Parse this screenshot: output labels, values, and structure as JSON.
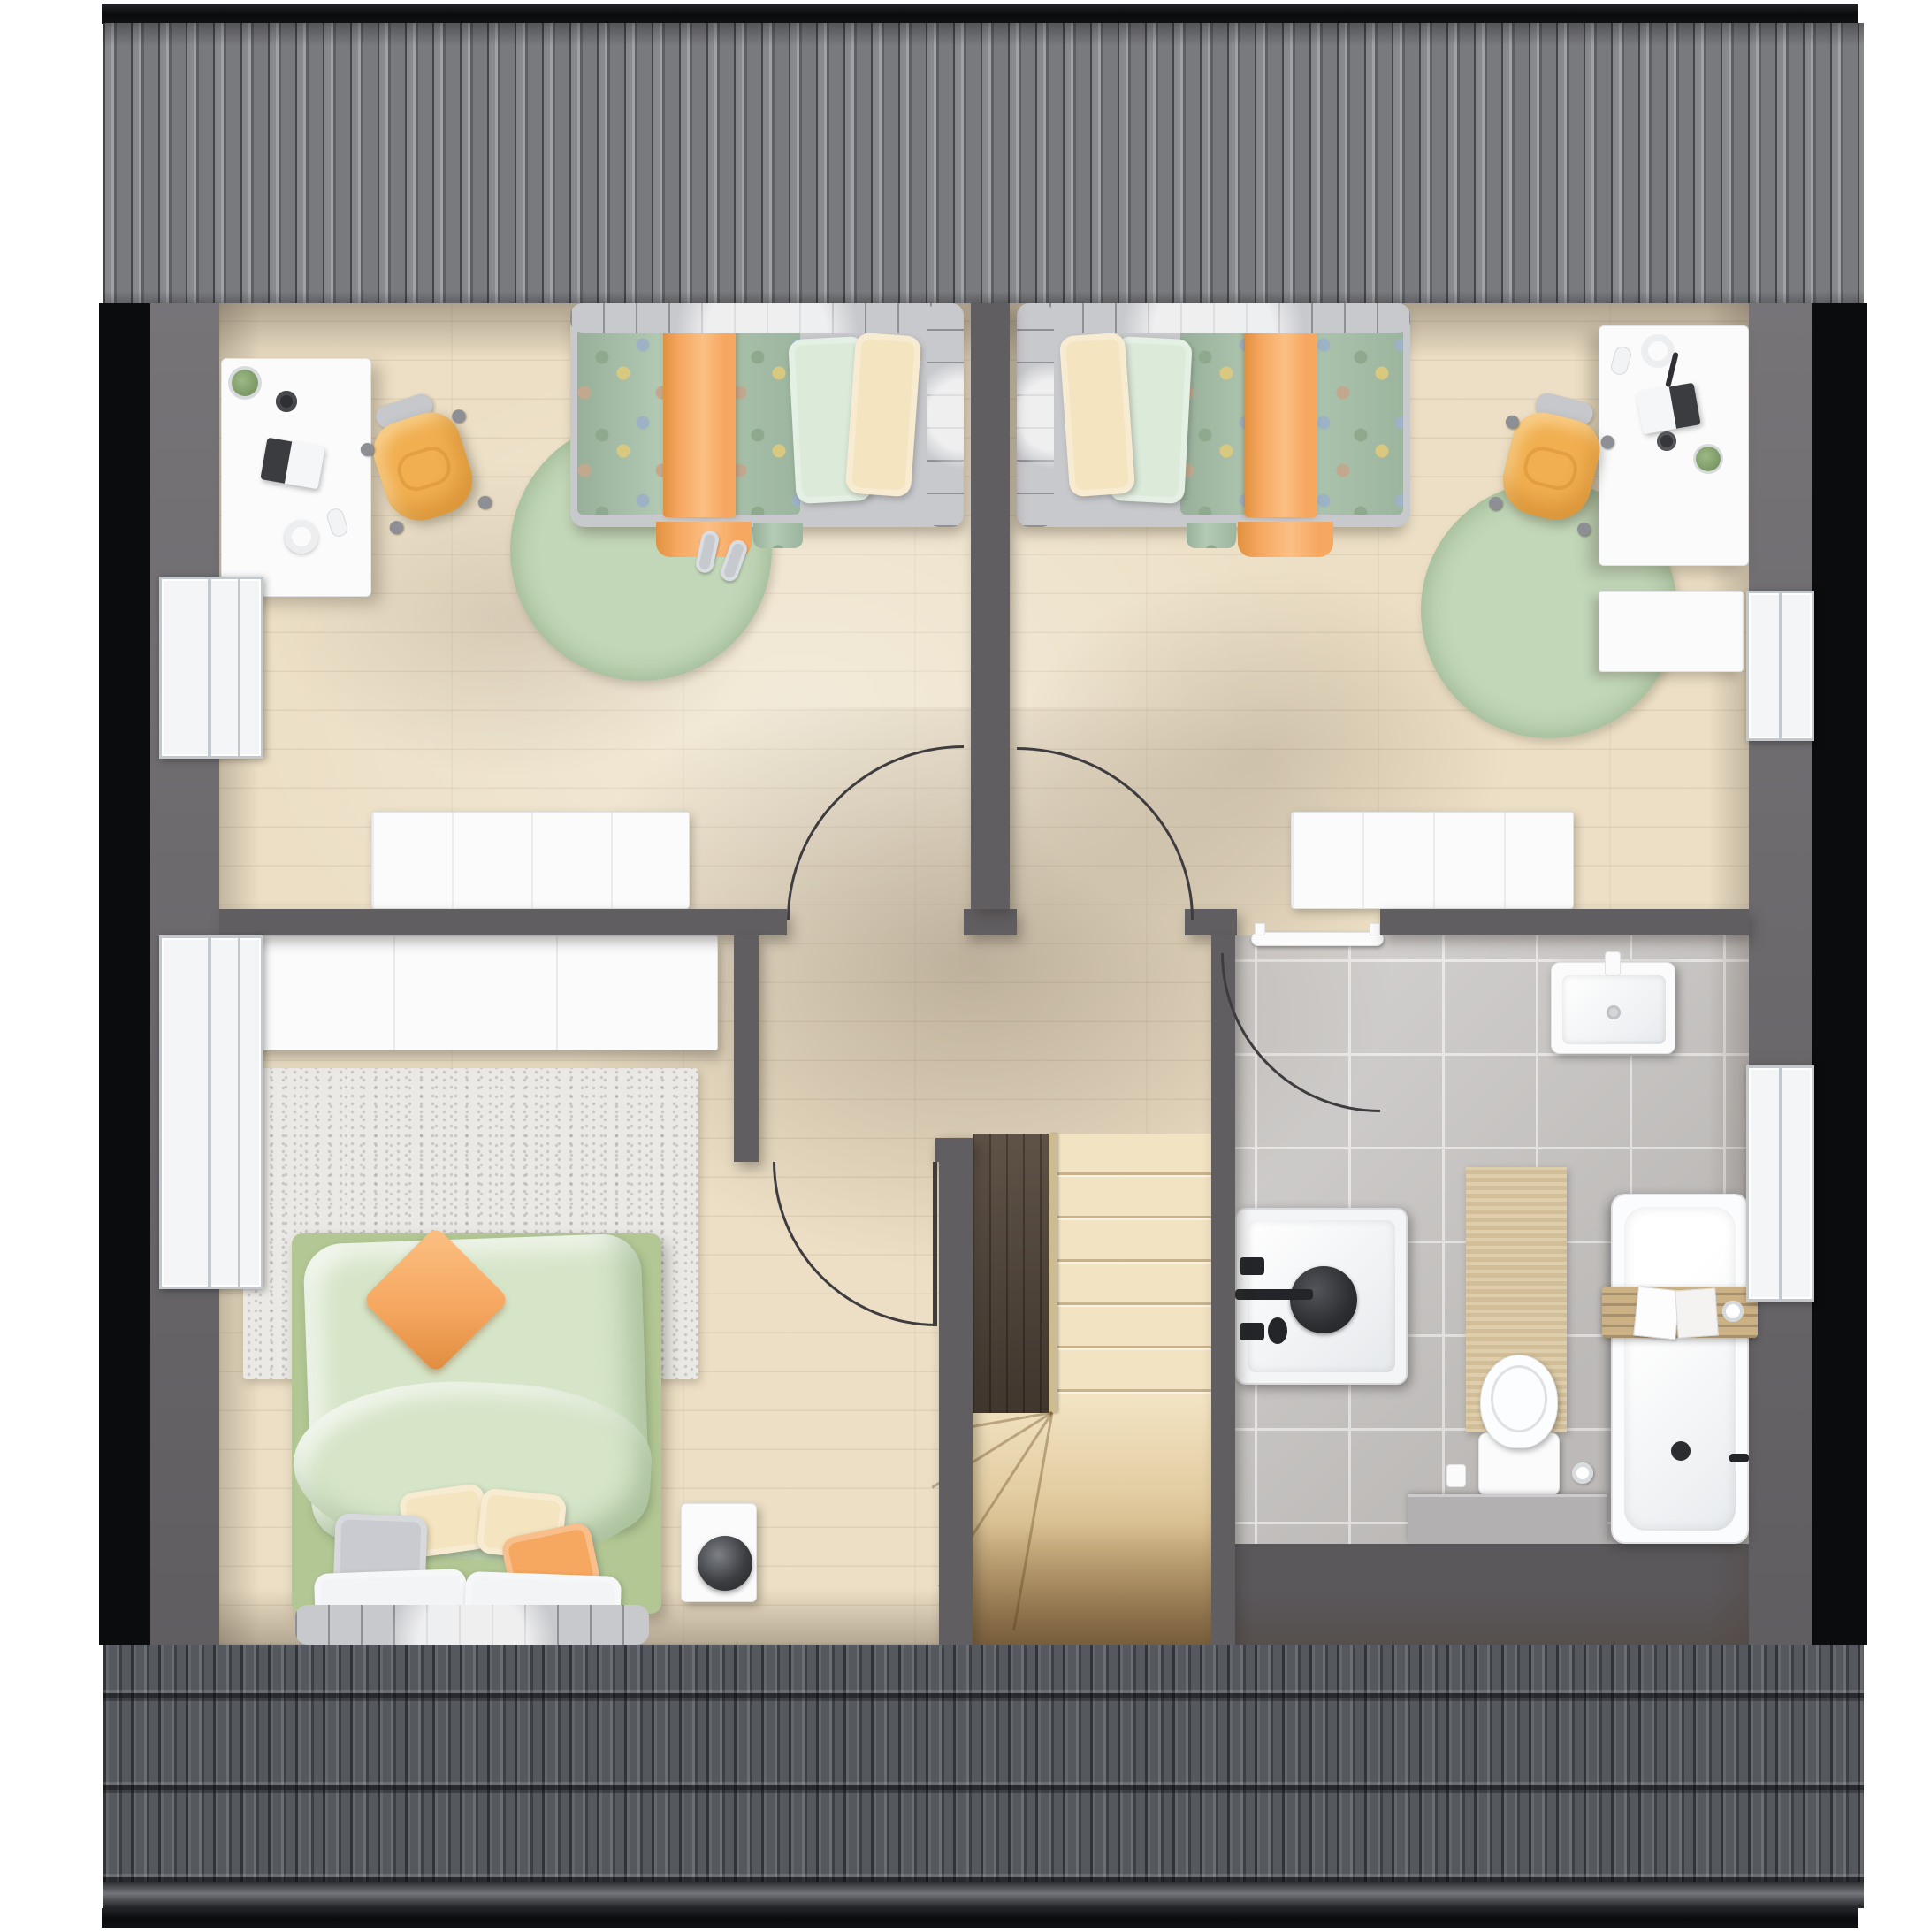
{
  "scene": {
    "title": "Attic storey floor plan – photorealistic top-down render",
    "type": "architectural floor plan",
    "view": "top-down",
    "storey": "attic / upper floor",
    "roof": "ridge with corrugated sheet at top, pan-tile slope at bottom"
  },
  "palette": {
    "page_white": "#ffffff",
    "outline_black": "#0b0c0e",
    "roof_top": "#797a7e",
    "roof_bottom": "#55585e",
    "wall": "#615e62",
    "knee_wall": "#6b686c",
    "eaves_gray": "#5b585c",
    "wood_floor": "#ecdfc5",
    "tile_floor": "#c8c5c3",
    "rug_green": "#b9d0af",
    "rug_light": "#eae9e5",
    "duvet_green": "#a9c4ab",
    "master_green_base": "#b2c794",
    "sheet_green": "#d6e5c8",
    "accent_orange": "#f6a760",
    "pillow_cream": "#f4e4bf",
    "pillow_mint": "#dceada",
    "frame_gray": "#c8c9cd",
    "chair_yellow": "#f1af50",
    "furniture_white": "#fbfbfc",
    "stair_tread": "#f1e1bf",
    "stair_void": "#55483c",
    "mat_beige": "#dac69e",
    "caddy_wood": "#ccb185"
  },
  "rooms": [
    {
      "id": "bedroom-left",
      "label": "Children's bedroom (left)",
      "furniture": [
        "single bed with polka-dot duvet and orange blanket",
        "white desk with laptop, plant, mug, mouse, headphones",
        "yellow swivel chair",
        "round green rug",
        "white radiator",
        "slippers"
      ]
    },
    {
      "id": "bedroom-right",
      "label": "Children's bedroom (right)",
      "furniture": [
        "single bed with polka-dot duvet and orange blanket",
        "white desk with laptop, plant, headphones, mouse",
        "white cabinet",
        "yellow swivel chair",
        "round green rug",
        "white radiator"
      ]
    },
    {
      "id": "master-bedroom",
      "label": "Master bedroom",
      "furniture": [
        "double bed with light-green duvet and orange cushion",
        "white wardrobe",
        "light woven rug",
        "white nightstand",
        "black table lamp",
        "pillows in white, gray, cream and orange"
      ]
    },
    {
      "id": "bathroom",
      "label": "Bathroom",
      "furniture": [
        "washbasin",
        "square shower tray with black fixture",
        "bathtub with wooden caddy and magazines",
        "toilet with paper holder and brush",
        "beige bath mat",
        "towel rail",
        "low ledge"
      ]
    },
    {
      "id": "hallway",
      "label": "Landing / hallway",
      "furniture": [
        "four swing doors shown as quarter-circle arcs"
      ]
    },
    {
      "id": "staircase",
      "label": "Winder staircase",
      "furniture": [
        "straight flight",
        "winder treads",
        "open stairwell void"
      ]
    }
  ],
  "architecture": {
    "windows": 4,
    "window_positions": [
      "left wall – children's room",
      "left wall – master bedroom",
      "right wall – children's room",
      "right wall – bathroom"
    ],
    "doors": 4,
    "walls_color_name": "dark gray",
    "floor_materials": [
      "light wood planks",
      "gray ceramic tiles (bathroom)"
    ]
  }
}
